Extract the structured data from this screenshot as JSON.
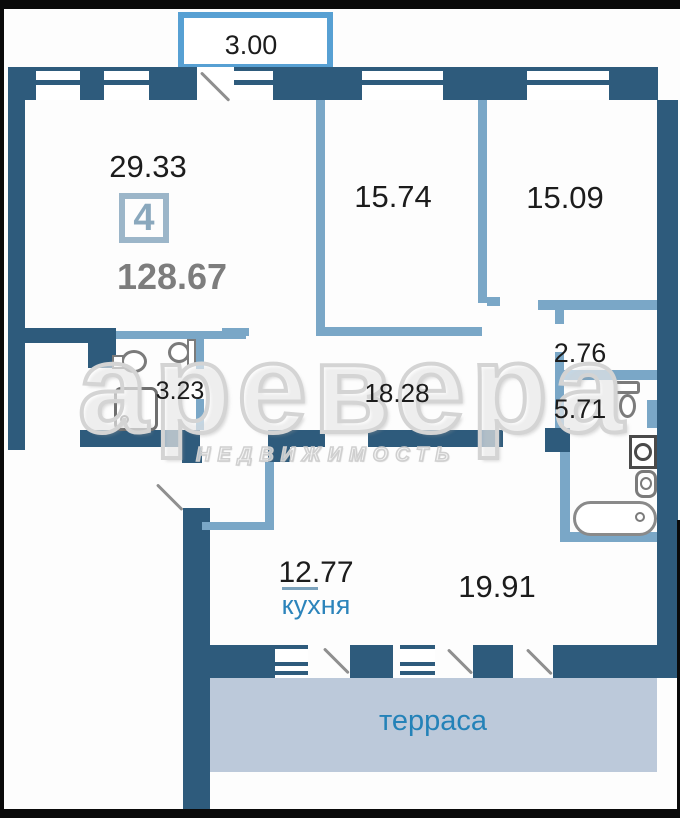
{
  "plan": {
    "summary": {
      "rooms_count": "4",
      "total_area": "128.67"
    },
    "rooms": [
      {
        "name": "room-main",
        "area": "29.33"
      },
      {
        "name": "bedroom-left",
        "area": "15.74"
      },
      {
        "name": "bedroom-right",
        "area": "15.09"
      },
      {
        "name": "bathroom-small",
        "area": "3.23"
      },
      {
        "name": "hallway",
        "area": "18.28"
      },
      {
        "name": "wardrobe",
        "area": "2.76"
      },
      {
        "name": "bathroom-large",
        "area": "5.71"
      },
      {
        "name": "kitchen",
        "area": "12.77",
        "label": "кухня"
      },
      {
        "name": "living-dining",
        "area": "19.91"
      },
      {
        "name": "balcony",
        "area": "3.00"
      },
      {
        "name": "terrace",
        "label": "терраса"
      }
    ],
    "colors": {
      "wall": "#2e5b7c",
      "partition": "#7aa7c7",
      "balcony_outline": "#57a0d3",
      "terrace_fill": "#bcc9da",
      "accent_text": "#2482b8",
      "total_text": "#7d7d7d"
    }
  },
  "watermark": {
    "title": "аревера",
    "subtitle": "НЕДВИЖИМОСТЬ"
  }
}
